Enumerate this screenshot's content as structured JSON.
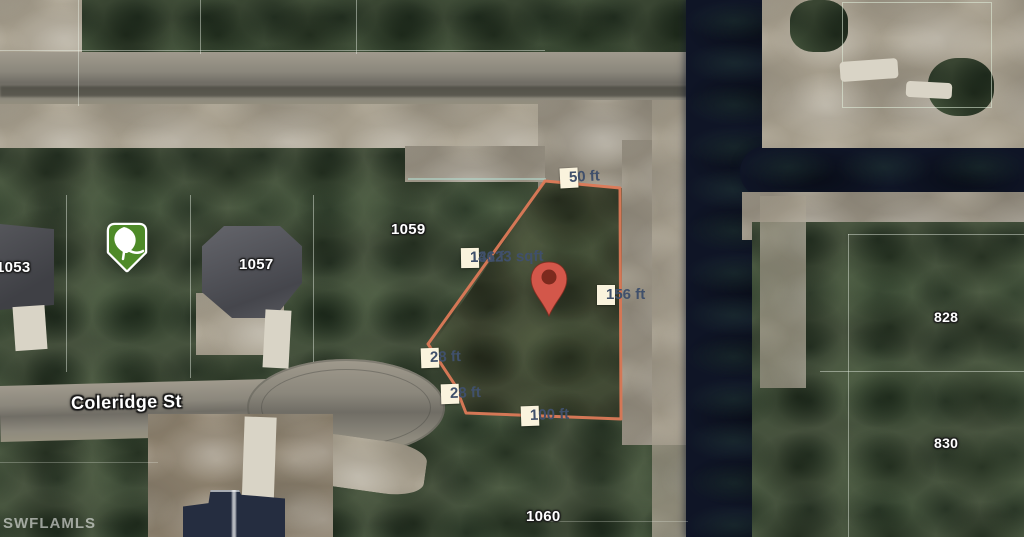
{
  "map": {
    "watermark": "SWFLAMLS",
    "street": {
      "name": "Coleridge St"
    },
    "parcel": {
      "area_label": "14623 sqft",
      "edges": {
        "north": "50 ft",
        "northwest": "131 f",
        "east": "156 ft",
        "southwest_upper": "28 ft",
        "southwest_lower": "28 ft",
        "south": "100 ft"
      }
    },
    "lot_numbers": {
      "n1053": "1053",
      "n1057": "1057",
      "n1059": "1059",
      "n1060": "1060",
      "n828": "828",
      "n830": "830"
    },
    "markers": {
      "location_pin": "red-location-pin",
      "tree_badge": "green-tree-shield-badge"
    },
    "colors": {
      "parcel_outline": "#dd7a58",
      "label_background": "#faf3dd",
      "label_text": "#40506b",
      "pin": "#d3574a",
      "pin_core": "#7c2a1e",
      "badge_green": "#4e8a28",
      "canal_water": "#0f1526"
    }
  }
}
